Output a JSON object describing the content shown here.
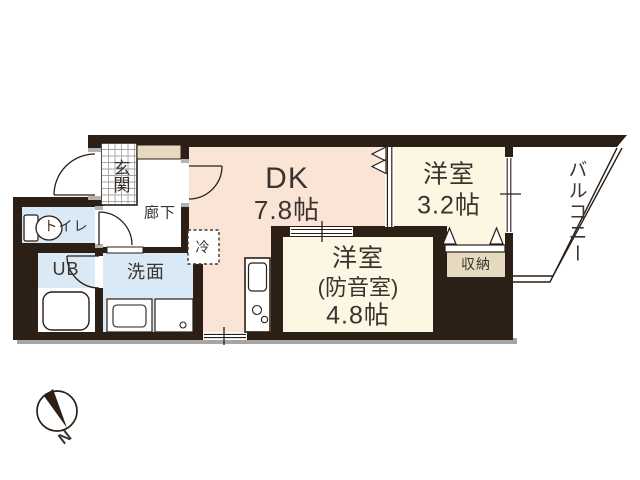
{
  "plan_title": "1DK+S apartment floor plan",
  "palette": {
    "wall": "#2b1f16",
    "dk_floor": "#fae4d5",
    "western_room_floor": "#fbf7e3",
    "wet_area_floor": "#d9e9f5",
    "storage_floor": "#e5dabf",
    "shadow": "#a5a5a5",
    "text": "#3a332e",
    "tile_grid": "#a5a5a5"
  },
  "rooms": {
    "dk": {
      "name": "DK",
      "size": "7.8帖"
    },
    "western": {
      "name": "洋室",
      "size": "3.2帖"
    },
    "soundproof": {
      "name": "洋室",
      "sub": "(防音室)",
      "size": "4.8帖"
    },
    "entrance": {
      "label": "玄関"
    },
    "hallway": {
      "label": "廊下"
    },
    "toilet": {
      "label": "トイレ"
    },
    "unit_bath": {
      "label": "UB"
    },
    "washroom": {
      "label": "洗面"
    },
    "storage": {
      "label": "収納"
    },
    "balcony": {
      "label": "バルコニー"
    },
    "refrigerator": {
      "label": "冷"
    }
  },
  "compass": {
    "north_label": "N"
  }
}
